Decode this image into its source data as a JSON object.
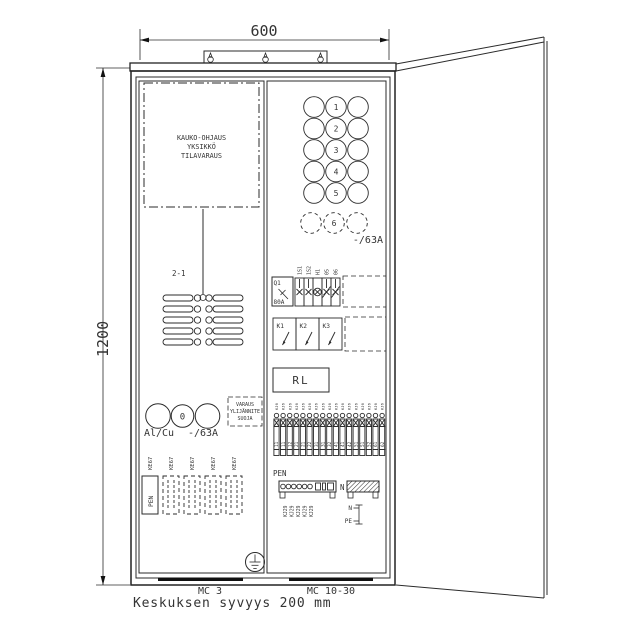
{
  "dimensions": {
    "width": "600",
    "height": "1200"
  },
  "depth_note": "Keskuksen syvyys 200 mm",
  "reserved_unit": {
    "lines": [
      "KAUKO-OHJAUS",
      "YKSIKKÖ",
      "TILAVARAUS"
    ]
  },
  "wire_label": "2-1",
  "meter_grid": {
    "numbers": [
      "1",
      "2",
      "3",
      "4",
      "5"
    ],
    "dashed_number": "6",
    "rating": "-/63A"
  },
  "main_meter": {
    "number": "0",
    "material": "Al/Cu",
    "rating": "-/63A"
  },
  "surge_box": {
    "lines": [
      "VARAUS",
      "YLIJÄNNITE",
      "SUOJA"
    ]
  },
  "ke67_labels": [
    "KE67",
    "KE67",
    "KE67",
    "KE67",
    "KE67"
  ],
  "pen_terminal_box": {
    "label": "PEN"
  },
  "main_switch": {
    "id": "Q1",
    "rating": "80A"
  },
  "component_labels": [
    "1S1",
    "1S2",
    "H1",
    "05",
    "06"
  ],
  "contactors": [
    "K1",
    "K2",
    "K3"
  ],
  "relay_label": "RL",
  "terminals": {
    "top_label": "KJ6",
    "numbers": [
      "11",
      "11",
      "12",
      "21",
      "21",
      "22",
      "31",
      "31",
      "32",
      "41",
      "41",
      "42",
      "51",
      "51",
      "52",
      "61",
      "62"
    ]
  },
  "pen_bar": {
    "label": "PEN",
    "terminal_labels": [
      "KJ29",
      "KJ29",
      "KJ29",
      "KJ29",
      "KJ29"
    ]
  },
  "n_bar": {
    "label": "N"
  },
  "npe_link": {
    "n": "N",
    "pe": "PE"
  },
  "cable_entries": [
    "MC 3",
    "MC 10-30"
  ],
  "colors": {
    "line": "#2b2b2b",
    "text": "#3f3f3f"
  }
}
